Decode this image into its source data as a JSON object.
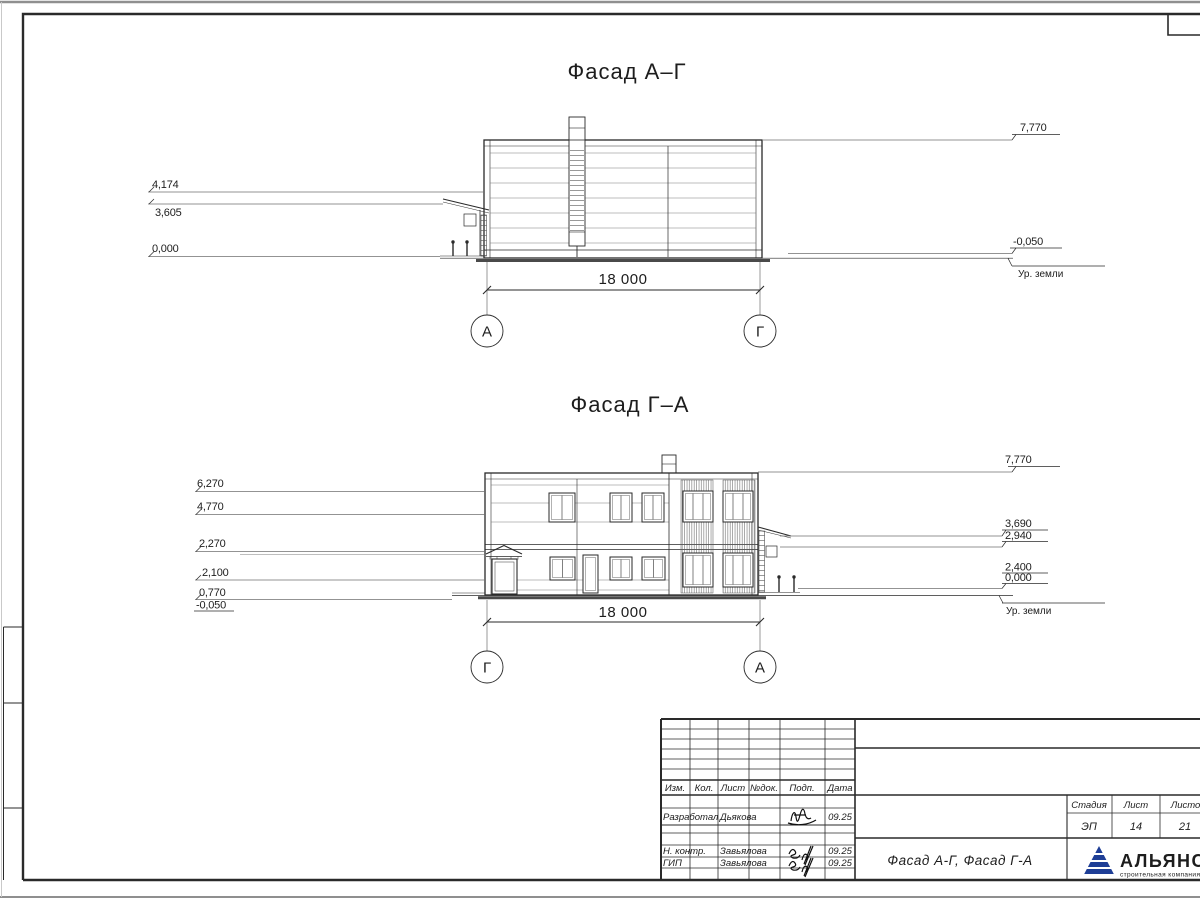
{
  "sheet": {
    "line_color": "#2a2a2a",
    "thin_color": "#6f6f6f",
    "edge_color": "#8f8f8f"
  },
  "facade_top": {
    "title": "Фасад А–Г",
    "elev_left": [
      "4,174",
      "3,605",
      "0,000"
    ],
    "elev_right_top": "7,770",
    "elev_right_ground": "-0,050",
    "ground_label": "Ур. земли",
    "span_dim": "18 000",
    "axis_left": "А",
    "axis_right": "Г"
  },
  "facade_bottom": {
    "title": "Фасад Г–А",
    "elev_left": [
      "6,270",
      "4,770",
      "2,270",
      "2,100",
      "0,770",
      "-0,050"
    ],
    "elev_right": [
      "7,770",
      "3,690",
      "2,940",
      "2,400",
      "0,000"
    ],
    "ground_label": "Ур. земли",
    "span_dim": "18 000",
    "axis_left": "Г",
    "axis_right": "А"
  },
  "title_block": {
    "columns": [
      "Изм.",
      "Кол.",
      "Лист",
      "№док.",
      "Подп.",
      "Дата"
    ],
    "rows": [
      {
        "role": "Разработал",
        "name": "Дьякова",
        "date": "09.25"
      },
      {
        "role": "Н. контр.",
        "name": "Завьялова",
        "date": "09.25"
      },
      {
        "role": "ГИП",
        "name": "Завьялова",
        "date": "09.25"
      }
    ],
    "doc_title": "Фасад А-Г, Фасад Г-А",
    "stage_header": "Стадия",
    "sheet_header": "Лист",
    "sheets_header": "Листов",
    "stage": "ЭП",
    "sheet_no": "14",
    "sheets_total": "21",
    "logo": {
      "name": "АЛЬЯНС",
      "tagline": "строительная компания",
      "primary": "#1e3e96",
      "secondary": "#4a9fd4"
    }
  }
}
